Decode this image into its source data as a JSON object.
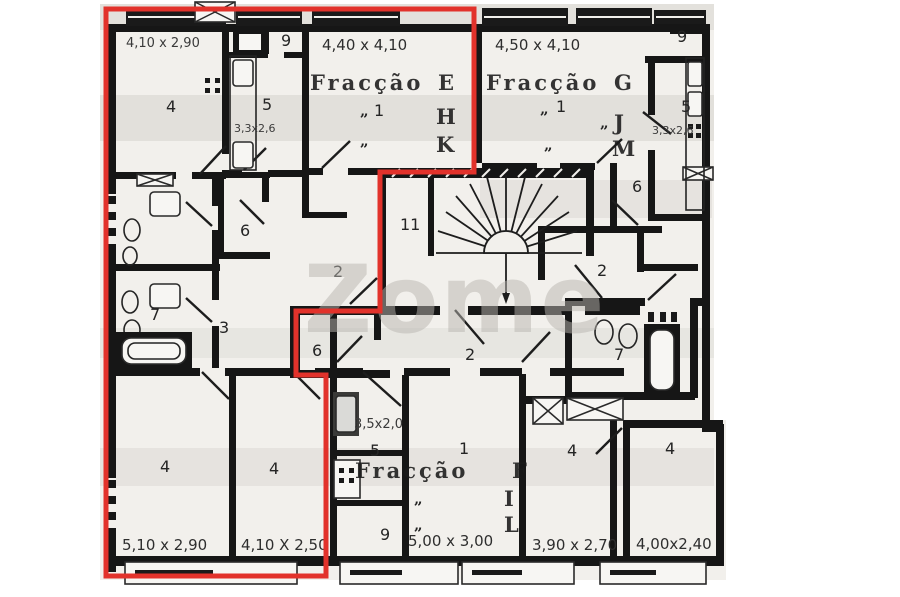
{
  "watermark": "Zome",
  "highlight_color": "#e2322b",
  "fractions": [
    {
      "name": "Fracção",
      "letter": "E",
      "also": [
        "H",
        "K"
      ],
      "living_number": "1",
      "living_dims": "4,40 x 4,10"
    },
    {
      "name": "Fracção",
      "letter": "G",
      "also": [
        "J",
        "M"
      ],
      "living_number": "1",
      "living_dims": "4,50 x 4,10"
    },
    {
      "name": "Fracção",
      "letter": "F",
      "also": [
        "I",
        "L"
      ],
      "living_number": "1",
      "living_dims": "5,00 x 3,00"
    }
  ],
  "texts": {
    "fraccao": "Fracção",
    "letter_e": "E",
    "letter_h": "H",
    "letter_k": "K",
    "letter_g": "G",
    "letter_j": "J",
    "letter_m": "M",
    "letter_f": "F",
    "letter_i": "I",
    "letter_l": "L",
    "ditto": "„",
    "dim_bed_topleft": "4,10 x 2,90",
    "num_bed_topleft": "4",
    "num_balcony_topleft": "9",
    "num_kitchen_topleft": "5",
    "dim_kitchen_topleft": "3,3x2,6",
    "dim_living_e": "4,40 x 4,10",
    "num_living_e": "1",
    "dim_living_g": "4,50 x 4,10",
    "num_living_g": "1",
    "num_balcony_topright": "9",
    "num_kitchen_topright": "5",
    "dim_kitchen_topright": "3,3x2,6",
    "num_room6_right": "6",
    "num_elevator": "11",
    "num_hall2_left": "2",
    "num_hall2_right": "2",
    "num_room6_leftmid": "6",
    "num_bath_left": "7",
    "num_hall3": "3",
    "num_room6_center": "6",
    "num_hall2_f": "2",
    "num_bath_right": "7",
    "dim_kitchen_f": "3,5x2,0",
    "num_kitchen_f": "5",
    "num_living_f": "1",
    "dim_living_f": "5,00 x 3,00",
    "num_balcony_f": "9",
    "num_bed_br1": "4",
    "dim_bed_br1": "3,90 x 2,70",
    "num_bed_br2": "4",
    "dim_bed_br2": "4,00x2,40",
    "num_bed_bl1": "4",
    "dim_bed_bl1": "5,10 x 2,90",
    "num_bed_bl2": "4",
    "dim_bed_bl2": "4,10 X 2,50",
    "watermark": "Zome"
  }
}
